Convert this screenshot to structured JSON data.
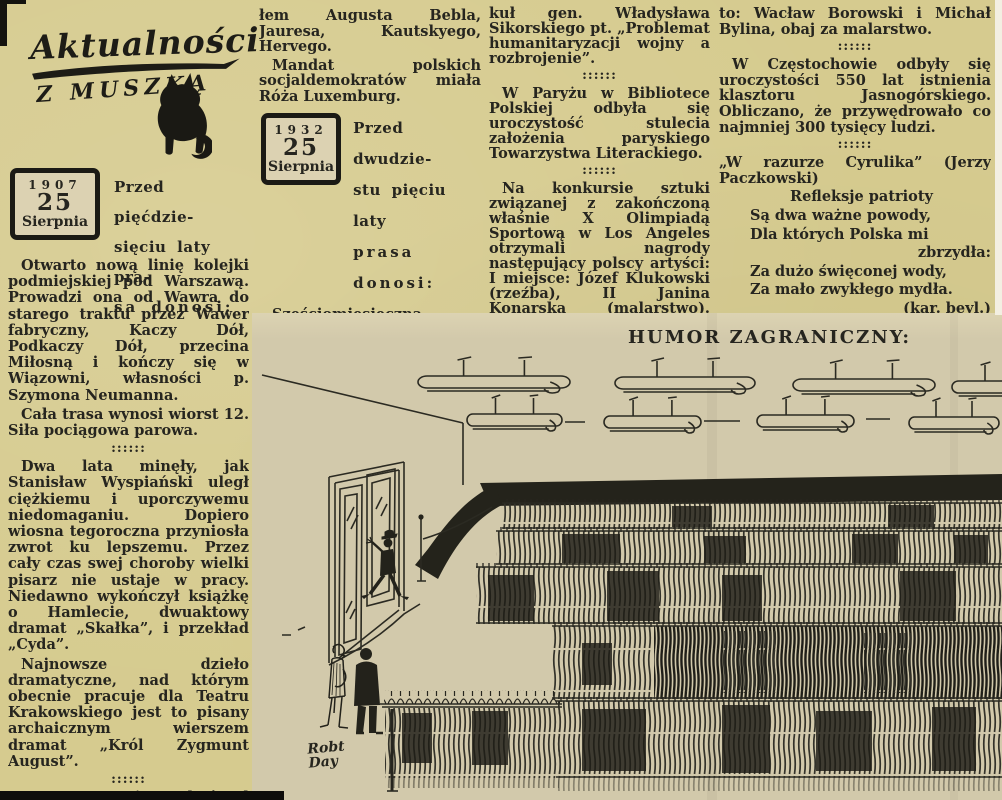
{
  "masthead": {
    "title": "Aktualności",
    "subtitle": "z muszką"
  },
  "sep": "::::::",
  "stamp1907": {
    "year": "1907",
    "day": "25",
    "month": "Sierpnia"
  },
  "intro1907": {
    "l1": "Przed pięćdzie-",
    "l2": "sięciu laty pra-",
    "l3": "sa donosi:"
  },
  "stamp1932": {
    "year": "1932",
    "day": "25",
    "month": "Sierpnia"
  },
  "intro1932": {
    "l1": "Przed dwudzie-",
    "l2": "stu pięciu laty",
    "l3": "prasa donosi:"
  },
  "col1": {
    "p1": "Otwarto nową linię kolejki podmiejskiej pod Warszawą. Prowadzi ona od Wawra do starego traktu przez Wawer fabryczny, Kaczy Dół, Podkaczy Dół, przecina Miłosną i kończy się w Wiązowni, własności p. Szymona Neumanna.",
    "p2": "Cała trasa wynosi wiorst 12. Siła pociągowa parowa.",
    "p3": "Dwa lata minęły, jak Stanisław Wyspiański uległ ciężkiemu i uporczywemu niedomaganiu. Dopiero wiosna tegoroczna przyniosła zwrot ku lepszemu. Przez cały czas swej choroby wielki pisarz nie ustaje w pracy. Niedawno wykończył książkę o Hamlecie, dwuaktowy dramat „Skałka”, i przekład „Cyda”.",
    "p4": "Najnowsze dzieło dramatyczne, nad którym obecnie pracuje dla Teatru Krakowskiego jest to pisany archaicznym wierszem dramat „Król Zygmunt August”.",
    "p5": "W Stuttgarcie zakończył obrady międzynarodowy kongres socjalistów z udzia-"
  },
  "col2": {
    "p1": "łem Augusta Bebla, Jauresa, Kautskyego, Hervego.",
    "p2": "Mandat polskich socjaldemokratów miała Róża Luxemburg.",
    "p3": "Sześciomiesięczna konferencja rozbrojeniowa zamknęła swe obrady. Zakończono ją przyjęciem formuły min. Benesza. W związku z tym ukazał się w „Kurierze Warszawskim” arty-"
  },
  "col3": {
    "p1": "kuł gen. Władysława Sikorskiego pt. „Problemat humanitaryzacji wojny a rozbrojenie”.",
    "p2": "W Paryżu w Bibliotece Polskiej odbyła się uroczystość stulecia założenia paryskiego Towarzystwa Literackiego.",
    "p3": "Na konkursie sztuki związanej z zakończoną właśnie X Olimpiadą Sportową w Los Angeles otrzymali nagrody następujący polscy artyści: I miejsce: Józef Klukowski (rzeźba), II Janina Konarska (malarstwo). Wyróżnienia otrzymali nad-"
  },
  "col4": {
    "p1": "to: Wacław Borowski i Michał Bylina, obaj za malarstwo.",
    "p2": "W Częstochowie odbyły się uroczystości 550 lat istnienia klasztoru Jasnogórskiego. Obliczano, że przywędrowało co najmniej 300 tysięcy ludzi.",
    "poem_head": "„W razurze Cyrulika” (Jerzy Paczkowski)",
    "poem_title": "Refleksje patrioty",
    "line1": "Są dwa ważne powody,",
    "line2": "Dla których Polska mi",
    "line3": "zbrzydła:",
    "line4": "Za dużo święconej wody,",
    "line5": "Za mało zwykłego mydła.",
    "byline": "(kar. beyl.)"
  },
  "cartoon": {
    "heading": "HUMOR ZAGRANICZNY:",
    "signature_l1": "Robt",
    "signature_l2": "Day"
  }
}
